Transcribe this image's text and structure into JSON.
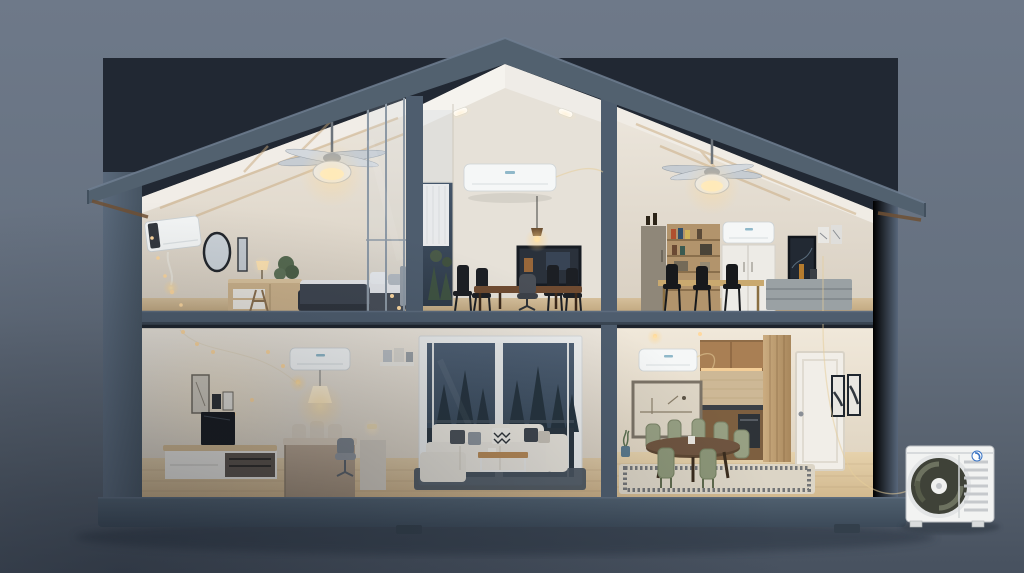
{
  "scene": {
    "title": "Two-story house cutaway showing a multi-zone ductless mini-split air-conditioning system",
    "style": "3D architectural cross-section illustration at dusk, slate blue-gray backdrop",
    "floors": 2,
    "rooms": [
      {
        "id": "upper-bedroom",
        "label": "bedroom (upper left)",
        "features": [
          "wall-mounted AC unit",
          "ceiling fan with dome light",
          "round mirror",
          "dresser with lamp",
          "potted plant",
          "bed with slate duvet",
          "glass partition",
          "warm string lights",
          "vaulted wood-truss ceiling"
        ]
      },
      {
        "id": "upper-dining",
        "label": "dining / work room (upper middle)",
        "features": [
          "wall-mounted AC unit",
          "two recessed ceiling lights",
          "pendant lamp",
          "dark framed panel",
          "wood dining table with black chairs",
          "office chair",
          "window with white curtain"
        ]
      },
      {
        "id": "upper-studio",
        "label": "studio / office (upper right)",
        "features": [
          "wall-mounted AC unit",
          "ceiling fan with dome light",
          "tall cabinet",
          "bookshelf",
          "white double cabinet",
          "dark art frame",
          "posters",
          "gray sideboard",
          "bar table with black stools"
        ]
      },
      {
        "id": "lower-living",
        "label": "living room (lower left)",
        "features": [
          "wall-mounted AC unit",
          "pendant cone lamp",
          "framed art",
          "TV on media console",
          "island desk with chairs",
          "wall shelf",
          "sliding glass door with pine forest night view",
          "white sectional sofa",
          "coffee table",
          "dark rug",
          "string lights"
        ]
      },
      {
        "id": "lower-dining",
        "label": "dining room and kitchen (lower right)",
        "features": [
          "wall-mounted AC unit",
          "framed sketch art",
          "kitchen nook with under-cabinet lighting",
          "wood slat partition",
          "white door",
          "pair of framed prints",
          "oval dining table",
          "sage-green chairs",
          "bordered rug"
        ]
      }
    ],
    "hvac": {
      "indoor_wall_units": 5,
      "outdoor_condenser_units": 1,
      "ceiling_fans": 2,
      "outdoor_unit_position": "on the ground to the right of the house",
      "line_set": "thin pale connecting line routed from the indoor units down the right side of the house to the outdoor unit"
    },
    "environment": {
      "sky": "overcast slate-blue dusk",
      "ground": "darker blue-gray with soft shadow under house",
      "house_shadow": true
    }
  },
  "colors": {
    "sky_top": "#6e7989",
    "sky_bottom": "#47515f",
    "frame": "#4e5d6e",
    "frame_light": "#5d6c7e",
    "frame_dark": "#3a4653",
    "roof": "#52616f",
    "soffit_wood": "#6f5034",
    "wall_warm": "#eae4da",
    "ceiling_white": "#f3f1ec",
    "floor_wood": "#d7c19d",
    "floor_wood_dark": "#c2a87f",
    "window_night": "#3c4a5c",
    "tree_silhouette": "#26343f",
    "warm_light": "#ffd9a0",
    "ac_white": "#f5f7f7",
    "rug_dark": "#4a555f",
    "rug_light": "#dcd5c6",
    "chair_sage": "#97a083",
    "table_wood": "#6f4b31",
    "kitchen_wood": "#a97f54",
    "sofa_white": "#e9e5dd",
    "duvet_slate": "#3e4550",
    "logo_blue": "#3a74c4"
  }
}
